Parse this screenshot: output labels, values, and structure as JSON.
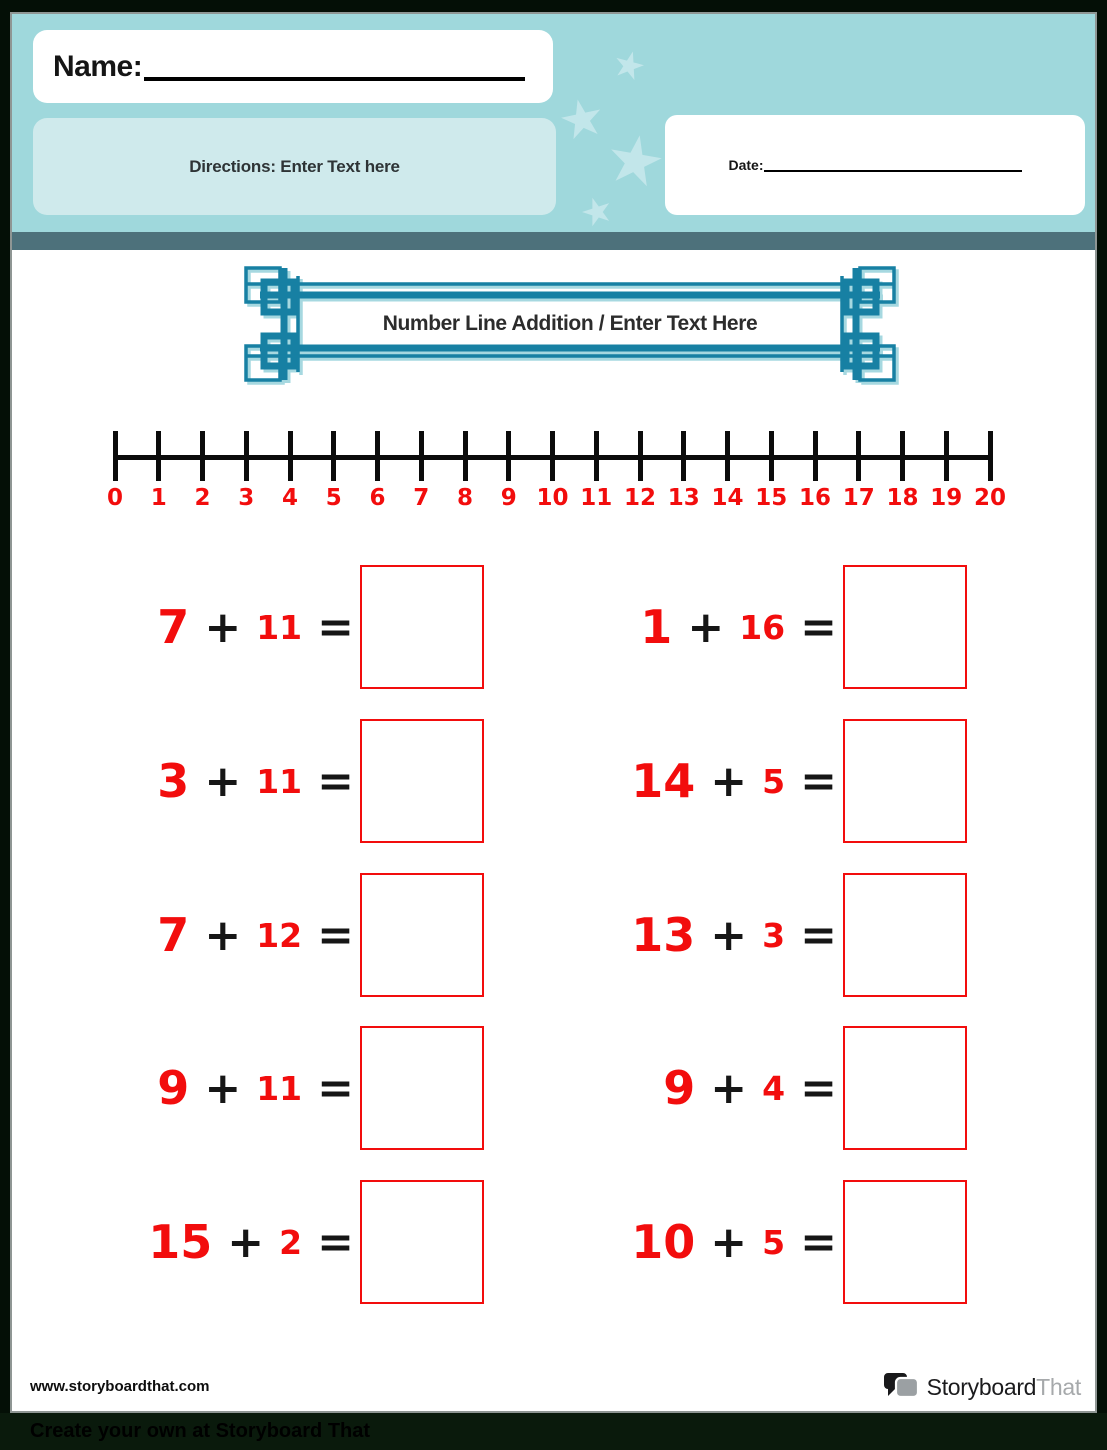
{
  "header": {
    "name_label": "Name:",
    "directions_text": "Directions: Enter Text here",
    "date_label": "Date:"
  },
  "title_banner": {
    "title": "Number Line Addition / Enter Text Here"
  },
  "number_line": {
    "min": 0,
    "max": 20,
    "labels": [
      "0",
      "1",
      "2",
      "3",
      "4",
      "5",
      "6",
      "7",
      "8",
      "9",
      "10",
      "11",
      "12",
      "13",
      "14",
      "15",
      "16",
      "17",
      "18",
      "19",
      "20"
    ]
  },
  "problems": {
    "plus": "+",
    "equals": "=",
    "rows": [
      {
        "cells": [
          {
            "a": "7",
            "b": "11"
          },
          {
            "a": "1",
            "b": "16"
          }
        ]
      },
      {
        "cells": [
          {
            "a": "3",
            "b": "11"
          },
          {
            "a": "14",
            "b": "5"
          }
        ]
      },
      {
        "cells": [
          {
            "a": "7",
            "b": "12"
          },
          {
            "a": "13",
            "b": "3"
          }
        ]
      },
      {
        "cells": [
          {
            "a": "9",
            "b": "11"
          },
          {
            "a": "9",
            "b": "4"
          }
        ]
      },
      {
        "cells": [
          {
            "a": "15",
            "b": "2"
          },
          {
            "a": "10",
            "b": "5"
          }
        ]
      }
    ]
  },
  "footer": {
    "website": "www.storyboardthat.com",
    "logo_primary": "Storyboard",
    "logo_secondary": "That",
    "bottom_bar_text": "Create your own at Storyboard That"
  },
  "colors": {
    "header_bg": "#9fd8dc",
    "directions_bg": "#cfeaec",
    "slate": "#4d717b",
    "frame_teal": "#1780a3",
    "frame_teal_light": "#a6d8e0",
    "red": "#f20d0d",
    "star": "#c2e6ea",
    "logo_gray": "#a6a9ab"
  }
}
